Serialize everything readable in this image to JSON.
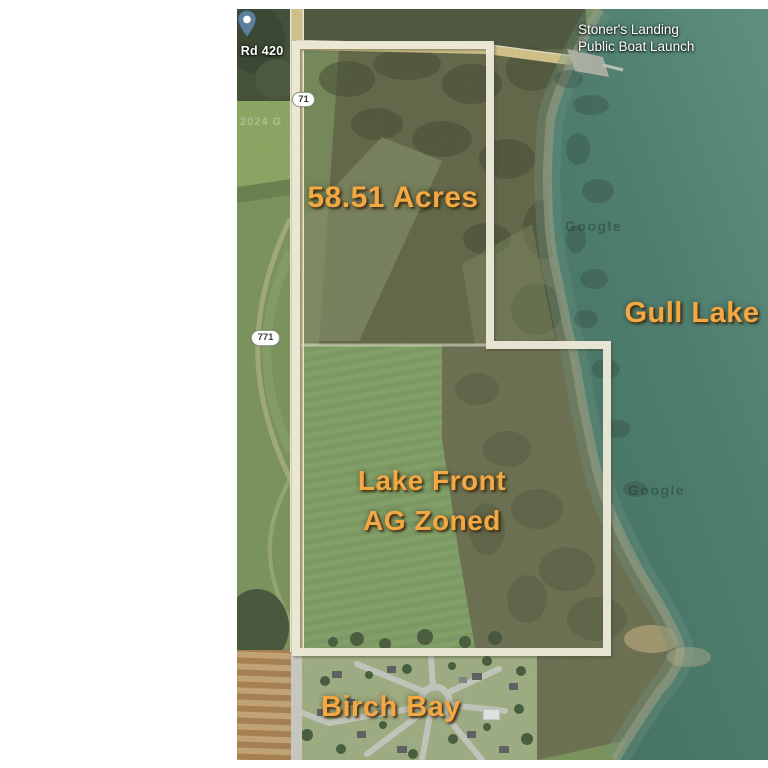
{
  "annotations": {
    "acreage": "58.51 Acres",
    "lake_name": "Gull Lake",
    "zoning_line1": "Lake Front",
    "zoning_line2": "AG Zoned",
    "subdivision": "Birch Bay"
  },
  "poi": {
    "boat_launch_line1": "Stoner's Landing",
    "boat_launch_line2": "Public Boat Launch"
  },
  "roads": {
    "road_label": "p Rd 420",
    "route_shield_1": "71",
    "route_shield_2": "771"
  },
  "watermarks": {
    "google_upper": "Google",
    "google_lower": "Google",
    "imagery_year": "2024 G"
  },
  "colors": {
    "annotation_orange": "#f4a843",
    "boundary_cream": "#ede9d8",
    "water_teal": "#4f8173",
    "pin_blue": "#5c7f9b"
  }
}
